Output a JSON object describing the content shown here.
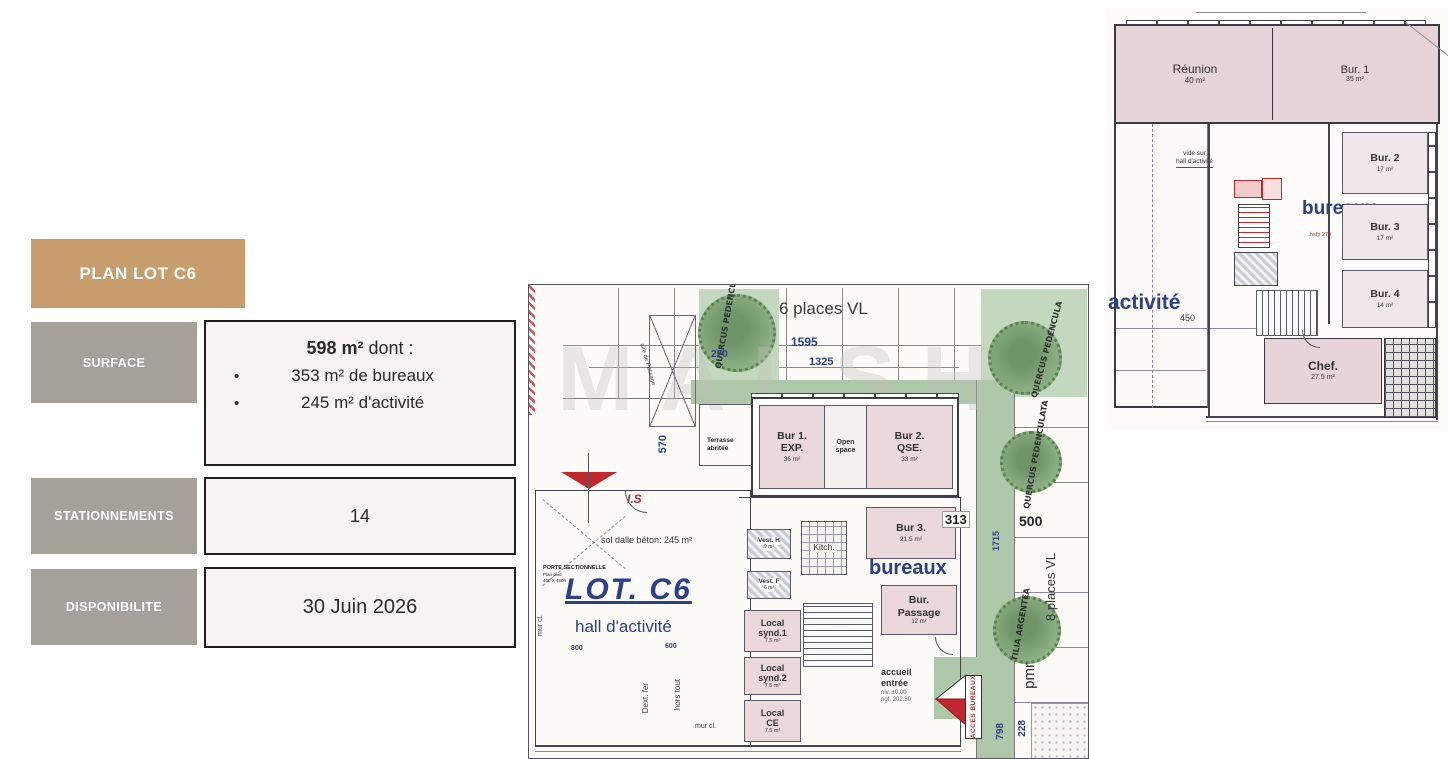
{
  "sidebar": {
    "title": "PLAN LOT C6",
    "bullet": "•",
    "surface": {
      "label": "SURFACE",
      "value_bold": "598 m²",
      "value_rest": " dont :",
      "bullet1": "353 m² de bureaux",
      "bullet2": "245 m² d'activité"
    },
    "stationnements": {
      "label": "STATIONNEMENTS",
      "value": "14"
    },
    "disponibilite": {
      "label": "DISPONIBILITE",
      "value": "30 Juin 2026"
    }
  },
  "main_plan": {
    "watermark": "MALSH",
    "parking_label": "6 places VL",
    "dims": {
      "d1595": "1595",
      "d1325": "1325",
      "d270": "270",
      "d570": "570",
      "d313": "313",
      "d500": "500",
      "d1715": "1715",
      "d798": "798",
      "d228": "228",
      "d800": "800",
      "d600": "600"
    },
    "trees": {
      "t1": "QUERCUS PEDENCULA",
      "t2": "QUERCUS PEDENCULA",
      "t3": "QUERCUS PEDENCULATA",
      "t4": "TILIA ARGENTEA"
    },
    "terrasse_l1": "Terrasse",
    "terrasse_l2": "abritée",
    "aire_note": "aire de Passage",
    "is_label": "I.S",
    "lot_title": "LOT. C6",
    "hall_label": "hall d'activité",
    "slab_note": "sol dalle béton: 245 m²",
    "porte_l1": "PORTE SECTIONNELLE",
    "porte_l2": "Plan plvd",
    "porte_l3": "400 X 450h",
    "mur_cl_left": "mur cl.",
    "mur_cl_bottom": "mur cl.",
    "dext_fer": "Dext. fer",
    "hors_tout": "hors tout",
    "places8": "8 places VL",
    "pmr": "pmr",
    "acces": "ACCES BUREAUX",
    "accueil_l1": "accueil",
    "accueil_l2": "entrée",
    "accueil_l3": "niv. ±0.00",
    "accueil_l4": "ngf. 202.80",
    "bureaux_label": "bureaux",
    "rooms": {
      "bur1_name": "Bur 1.",
      "bur1_sub": "EXP.",
      "bur1_area": "36 m²",
      "open_l1": "Open",
      "open_l2": "space",
      "bur2_name": "Bur 2.",
      "bur2_sub": "QSE.",
      "bur2_area": "33 m²",
      "bur3_name": "Bur 3.",
      "bur3_area": "21.5 m²",
      "pass_l1": "Bur.",
      "pass_l2": "Passage",
      "pass_area": "12 m²",
      "vesth_name": "Vest. H",
      "vesth_area": "9 m²",
      "vestf_name": "Vest. F",
      "vestf_area": "6 m²",
      "kitch": "Kitch.",
      "synd1_l1": "Local",
      "synd1_l2": "synd.1",
      "synd1_area": "7.5 m²",
      "synd2_l1": "Local",
      "synd2_l2": "synd.2",
      "synd2_area": "7.5 m²",
      "ce_l1": "Local",
      "ce_l2": "CE",
      "ce_area": "7.5 m²"
    }
  },
  "upper_plan": {
    "rooms": {
      "reunion_name": "Réunion",
      "reunion_area": "40 m²",
      "bur1_name": "Bur. 1",
      "bur1_area": "35 m²",
      "bur2_name": "Bur. 2",
      "bur2_area": "17 m²",
      "bur3_name": "Bur. 3",
      "bur3_area": "17 m²",
      "bur4_name": "Bur. 4",
      "bur4_area": "14 m²",
      "chef_name": "Chef.",
      "chef_area": "27.5 m²"
    },
    "bureaux_label": "bureaux",
    "activite_label": "activité",
    "vide_l1": "vide sur",
    "vide_l2": "hall d'activité",
    "dim_450": "450",
    "note_red": "hsfp 279"
  },
  "colors": {
    "tan": "#c79d6e",
    "gray": "#a6a09a",
    "panel_bg": "#f8f2f3",
    "blue": "#2b3f8c",
    "red": "#c1272d",
    "green": "#aec7a9",
    "room_pink": "#ead8db"
  }
}
